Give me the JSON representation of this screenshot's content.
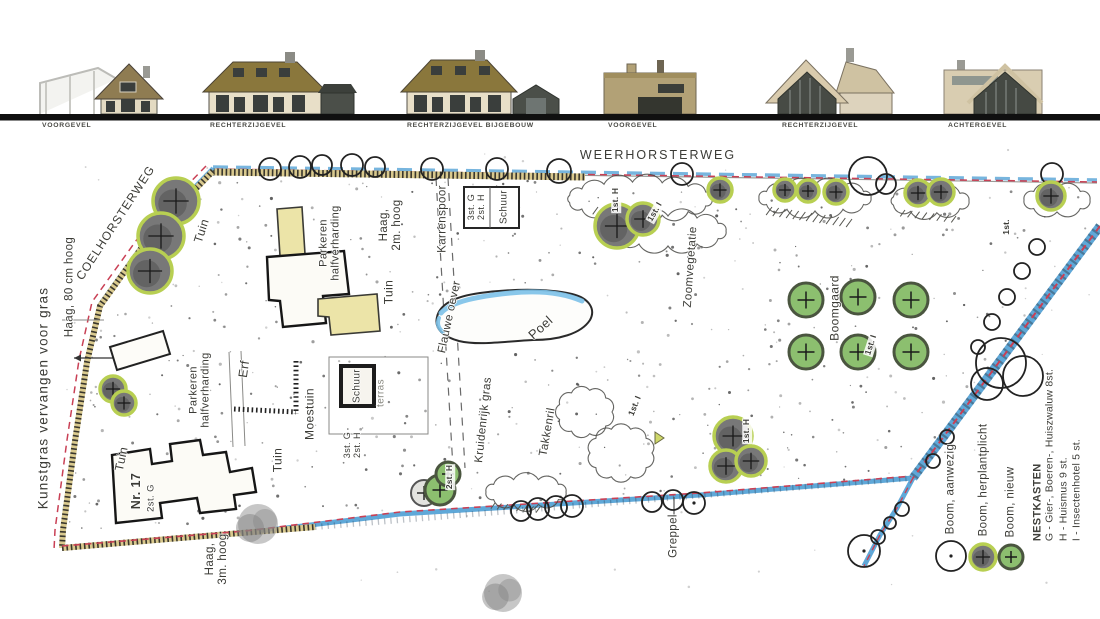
{
  "elevations": {
    "labels": [
      "VOORGEVEL",
      "RECHTERZIJGEVEL",
      "RECHTERZIJGEVEL BIJGEBOUW",
      "VOORGEVEL",
      "RECHTERZIJGEVEL",
      "ACHTERGEVEL"
    ]
  },
  "plan": {
    "roads": {
      "weerhorsterweg": "WEERHORSTERWEG",
      "coelhorsterweg": "COELHORSTERWEG"
    },
    "areas": {
      "tuin": "Tuin",
      "erf": "Erf",
      "moestuin": "Moestuin",
      "poel": "Poel",
      "flauwe_oever": "Flauwe oever",
      "kruidenrijk_gras": "Kruidenrijk gras",
      "takkenril": "Takkenril",
      "zoomvegetatie": "Zoomvegetatie",
      "boomgaard": "Boomgaard",
      "karrenspoor": "Karrenspoor",
      "parkeren": "Parkeren\nhalfverharding",
      "schuur": "Schuur",
      "terras": "terras",
      "greppel": "Greppel"
    },
    "hedges": {
      "kunstgras": "Kunstgras vervangen voor gras",
      "haag_80": "Haag, 80 cm hoog",
      "haag_2m": "Haag,\n2m. hoog",
      "haag_3m": "Haag,\n3m. hoog"
    },
    "house_number": "Nr. 17",
    "nestbox_marks": {
      "g2": "2st. G",
      "g3h2": "3st. G\n2st. H",
      "h2": "2st. H",
      "h1": "1st. H",
      "i1": "1st. I",
      "st1": "1st."
    }
  },
  "legend": {
    "boom_aanwezig": "Boom, aanwezig",
    "boom_herplantplicht": "Boom, herplantplicht",
    "boom_nieuw": "Boom, nieuw",
    "nestkasten_title": "NESTKASTEN",
    "nestkasten_g": "G - Gier-, Boeren-, Huiszwaluw 8st.",
    "nestkasten_h": "H - Huismus 9 st.",
    "nestkasten_i": "I - Insectenhotel 5 st."
  },
  "colors": {
    "water": "#5fa8d8",
    "boundary_red": "#c94055",
    "hedge_tan": "#d9c98e",
    "tree_ring_lime": "#b8cf52",
    "tree_new_fill": "#8cbf6f",
    "terrace_yellow": "#ece4a8",
    "roof_brown": "#8a773c",
    "annex_dark": "#4b4f49"
  }
}
